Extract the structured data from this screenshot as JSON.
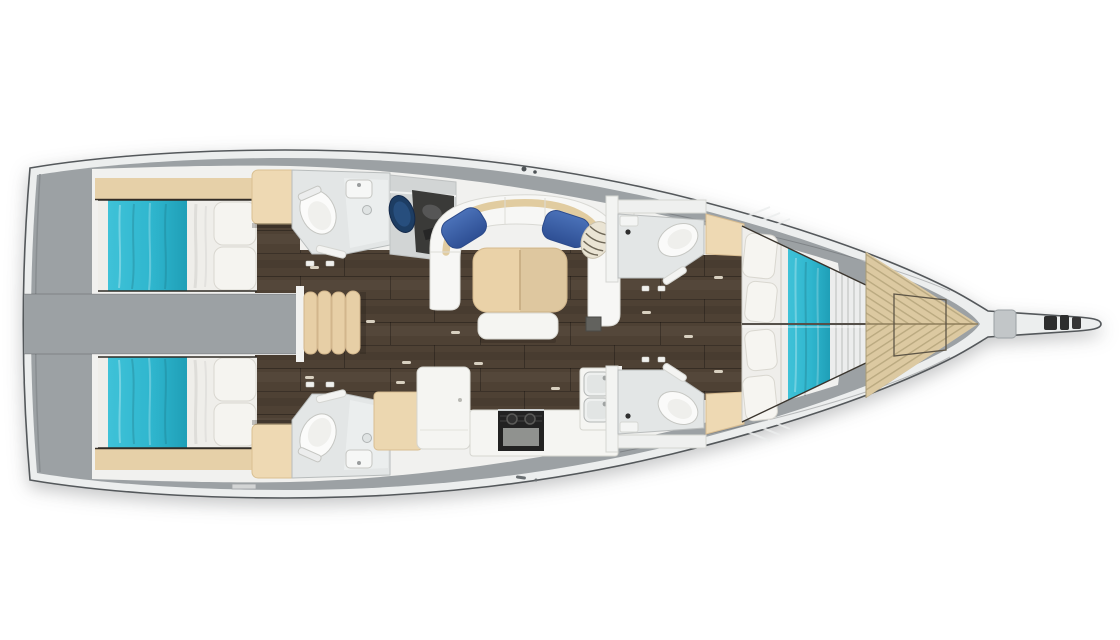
{
  "scene": {
    "type": "sailing-yacht-interior-floor-plan",
    "view": "top-down",
    "orientation": "bow-right"
  },
  "colors": {
    "background": "#ffffff",
    "deck_gray": "#9ca1a4",
    "hull_rim": "#eceeee",
    "hull_outline": "#54585b",
    "sole_white": "#f1f1ef",
    "floor_wood": "#4e4134",
    "bedding_teal": "#2fb6ce",
    "bedding_teal_dark": "#1fa0b8",
    "upholstery_tan": "#e9d2a9",
    "cabinet_tan": "#eed9b3",
    "sofa_white": "#f7f7f5",
    "pillow_blue": "#3e64ac",
    "nav_chair_navy": "#1d3d63",
    "teak_deck": "#dcc9a1",
    "appliance_dark": "#222222",
    "bath_floor": "#e3e6e6",
    "fixture_white": "#fafaf9"
  },
  "compartments": [
    {
      "id": "swim-platform",
      "label": "stern-swim-platform"
    },
    {
      "id": "aft-cabin-port",
      "label": "aft-double-cabin-port",
      "furniture": [
        "double-berth-teal-bedding",
        "pillows",
        "wardrobe",
        "headboard-shelf"
      ]
    },
    {
      "id": "aft-cabin-starboard",
      "label": "aft-double-cabin-starboard",
      "furniture": [
        "double-berth-teal-bedding",
        "pillows",
        "wardrobe",
        "headboard-shelf"
      ]
    },
    {
      "id": "cockpit-well",
      "label": "companionway-engine-space"
    },
    {
      "id": "companionway-steps",
      "label": "companionway-step-cushions"
    },
    {
      "id": "aft-head-port",
      "label": "aft-bathroom-port",
      "furniture": [
        "toilet",
        "sink",
        "shower-tray"
      ]
    },
    {
      "id": "aft-head-starboard",
      "label": "aft-bathroom-starboard",
      "furniture": [
        "toilet",
        "sink",
        "shower-tray"
      ]
    },
    {
      "id": "nav-station",
      "label": "navigation-station",
      "furniture": [
        "chart-table",
        "navigator-seat"
      ]
    },
    {
      "id": "salon",
      "label": "main-salon",
      "furniture": [
        "u-shaped-settee",
        "blue-cushion-left",
        "blue-cushion-right",
        "zebra-cushion",
        "tan-folding-table",
        "footstool-bench"
      ]
    },
    {
      "id": "galley",
      "label": "galley",
      "furniture": [
        "island-unit",
        "stove",
        "double-sink",
        "counter"
      ]
    },
    {
      "id": "forward-head-port",
      "label": "forward-bathroom-port",
      "furniture": [
        "toilet",
        "vanity"
      ]
    },
    {
      "id": "forward-head-starboard",
      "label": "forward-bathroom-starboard",
      "furniture": [
        "toilet",
        "vanity"
      ]
    },
    {
      "id": "forward-cabin",
      "label": "forward-v-berth-cabin",
      "furniture": [
        "v-berth-teal-runner",
        "pillows",
        "entry-cabinets"
      ]
    },
    {
      "id": "foredeck",
      "label": "teak-foredeck",
      "furniture": [
        "deck-hatch"
      ]
    },
    {
      "id": "bowsprit",
      "label": "bowsprit",
      "furniture": [
        "anchor-fittings"
      ]
    }
  ]
}
